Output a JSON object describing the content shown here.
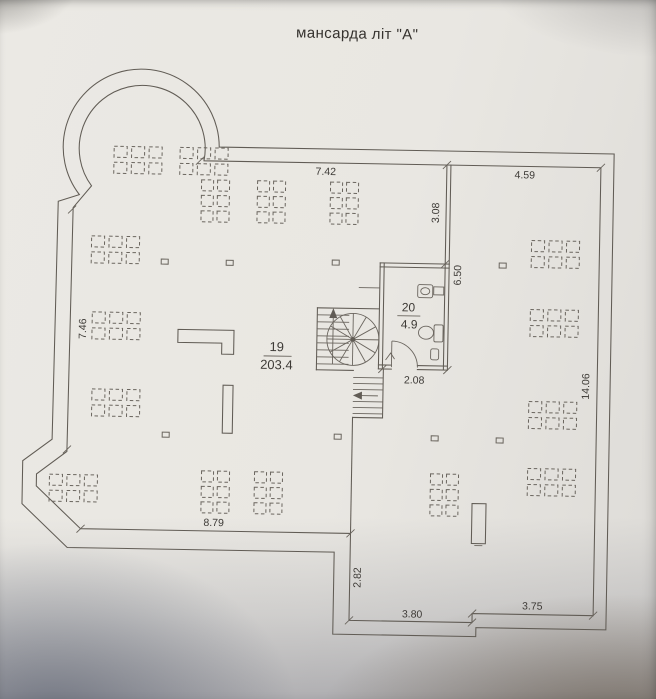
{
  "title": "мансарда літ \"А\"",
  "plan": {
    "rooms": [
      {
        "number": "19",
        "area": "203.4"
      },
      {
        "number": "20",
        "area": "4.9"
      }
    ],
    "dimensions": {
      "top_left": "7.42",
      "top_right": "4.59",
      "wall_upper": "3.08",
      "wall_lower": "6.50",
      "left": "7.46",
      "right": "14.06",
      "bottom": "8.79",
      "ext_left": "2.82",
      "ext_bottom_left": "3.80",
      "ext_bottom_right": "3.75",
      "bath_width": "2.08"
    },
    "colors": {
      "ink": "#615c55",
      "text": "#3d3a36",
      "paper": "#e8e6e1"
    }
  }
}
